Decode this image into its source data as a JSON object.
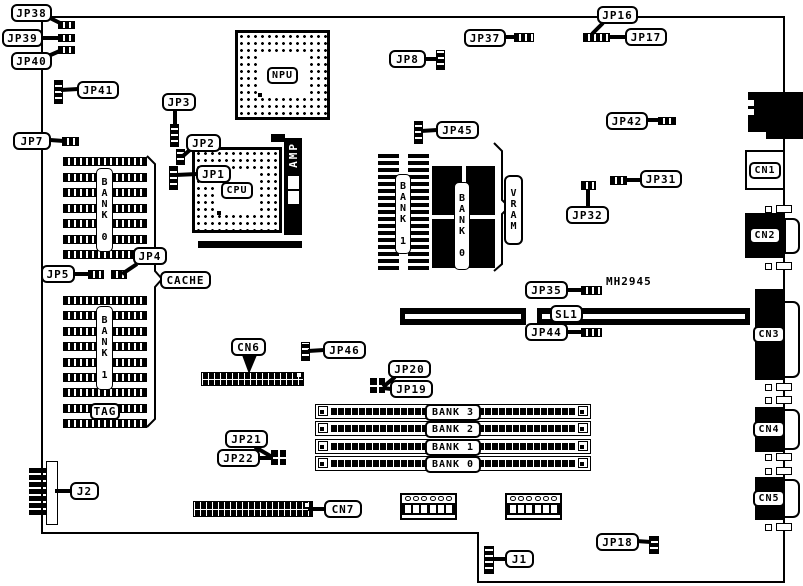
{
  "board": {
    "background_color": "#ffffff",
    "line_color": "#000000",
    "part_number": "MH2945",
    "callouts": {
      "jp38": "JP38",
      "jp39": "JP39",
      "jp40": "JP40",
      "jp41": "JP41",
      "jp7": "JP7",
      "jp3": "JP3",
      "jp2": "JP2",
      "jp1": "JP1",
      "jp8": "JP8",
      "jp37": "JP37",
      "jp16": "JP16",
      "jp17": "JP17",
      "jp42": "JP42",
      "jp45": "JP45",
      "jp31": "JP31",
      "jp32": "JP32",
      "jp35": "JP35",
      "jp44": "JP44",
      "jp5": "JP5",
      "jp4": "JP4",
      "cache": "CACHE",
      "cn6": "CN6",
      "jp46": "JP46",
      "jp20": "JP20",
      "jp19": "JP19",
      "jp21": "JP21",
      "jp22": "JP22",
      "j2": "J2",
      "cn7": "CN7",
      "j1": "J1",
      "jp18": "JP18",
      "sl1": "SL1"
    },
    "chips": {
      "cpu": "CPU",
      "npu": "NPU",
      "amp": "AMP",
      "tag": "TAG",
      "vram": "VRAM"
    },
    "memory": {
      "cache_banks": [
        "BANK 0",
        "BANK 1"
      ],
      "vram_banks": [
        "BANK 1",
        "BANK 0"
      ],
      "simm_banks": [
        "BANK 3",
        "BANK 2",
        "BANK 1",
        "BANK 0"
      ]
    },
    "connectors": {
      "cn1": "CN1",
      "cn2": "CN2",
      "cn3": "CN3",
      "cn4": "CN4",
      "cn5": "CN5"
    }
  }
}
